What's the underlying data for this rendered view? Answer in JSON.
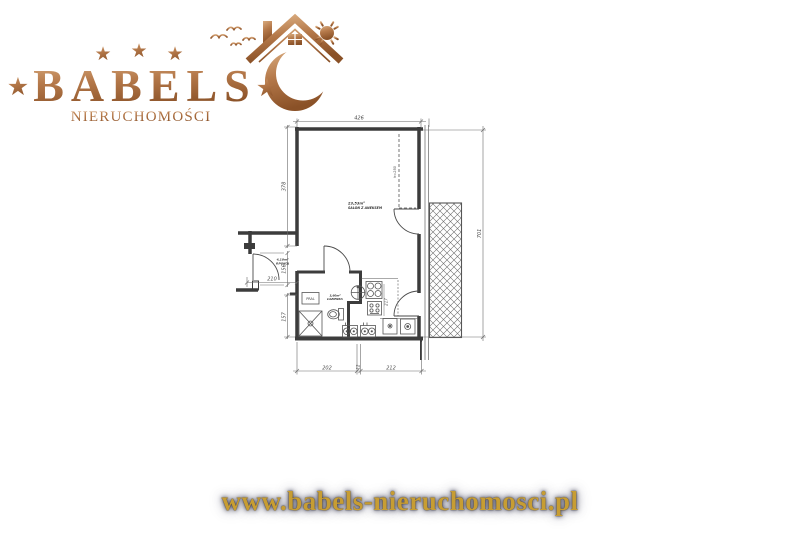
{
  "logo": {
    "brand": "BABELS",
    "subtitle": "NIERUCHOMOŚCI",
    "star": "★",
    "stars_top": [
      "★",
      "★",
      "★"
    ]
  },
  "footer": {
    "website": "www.babels-nieruchomosci.pl"
  },
  "colors": {
    "copper_light": "#d9ab7e",
    "copper": "#b5794a",
    "copper_dark": "#8a5127",
    "gold": "#c79d33",
    "wall": "#3c3c3c",
    "dim": "#4a4a4a"
  },
  "floorplan": {
    "rooms": {
      "salon": {
        "area": "23,53m²",
        "name": "SALON Z ANEKSEM"
      },
      "hallway": {
        "area": "4,10m²",
        "name": "P.POKÓJ"
      },
      "bathroom": {
        "area": "3,60m²",
        "name": "ŁAZIENKA"
      }
    },
    "labels": {
      "washer": "PRAL",
      "height": "h=250"
    },
    "dimensions": {
      "top": "426",
      "left_salon": "378",
      "left_entry": "156",
      "entry_width": "210",
      "left_bath": "157",
      "right_total": "701",
      "bottom_left": "202",
      "bottom_mid": "12",
      "bottom_right": "212",
      "kitchen": "217"
    }
  }
}
